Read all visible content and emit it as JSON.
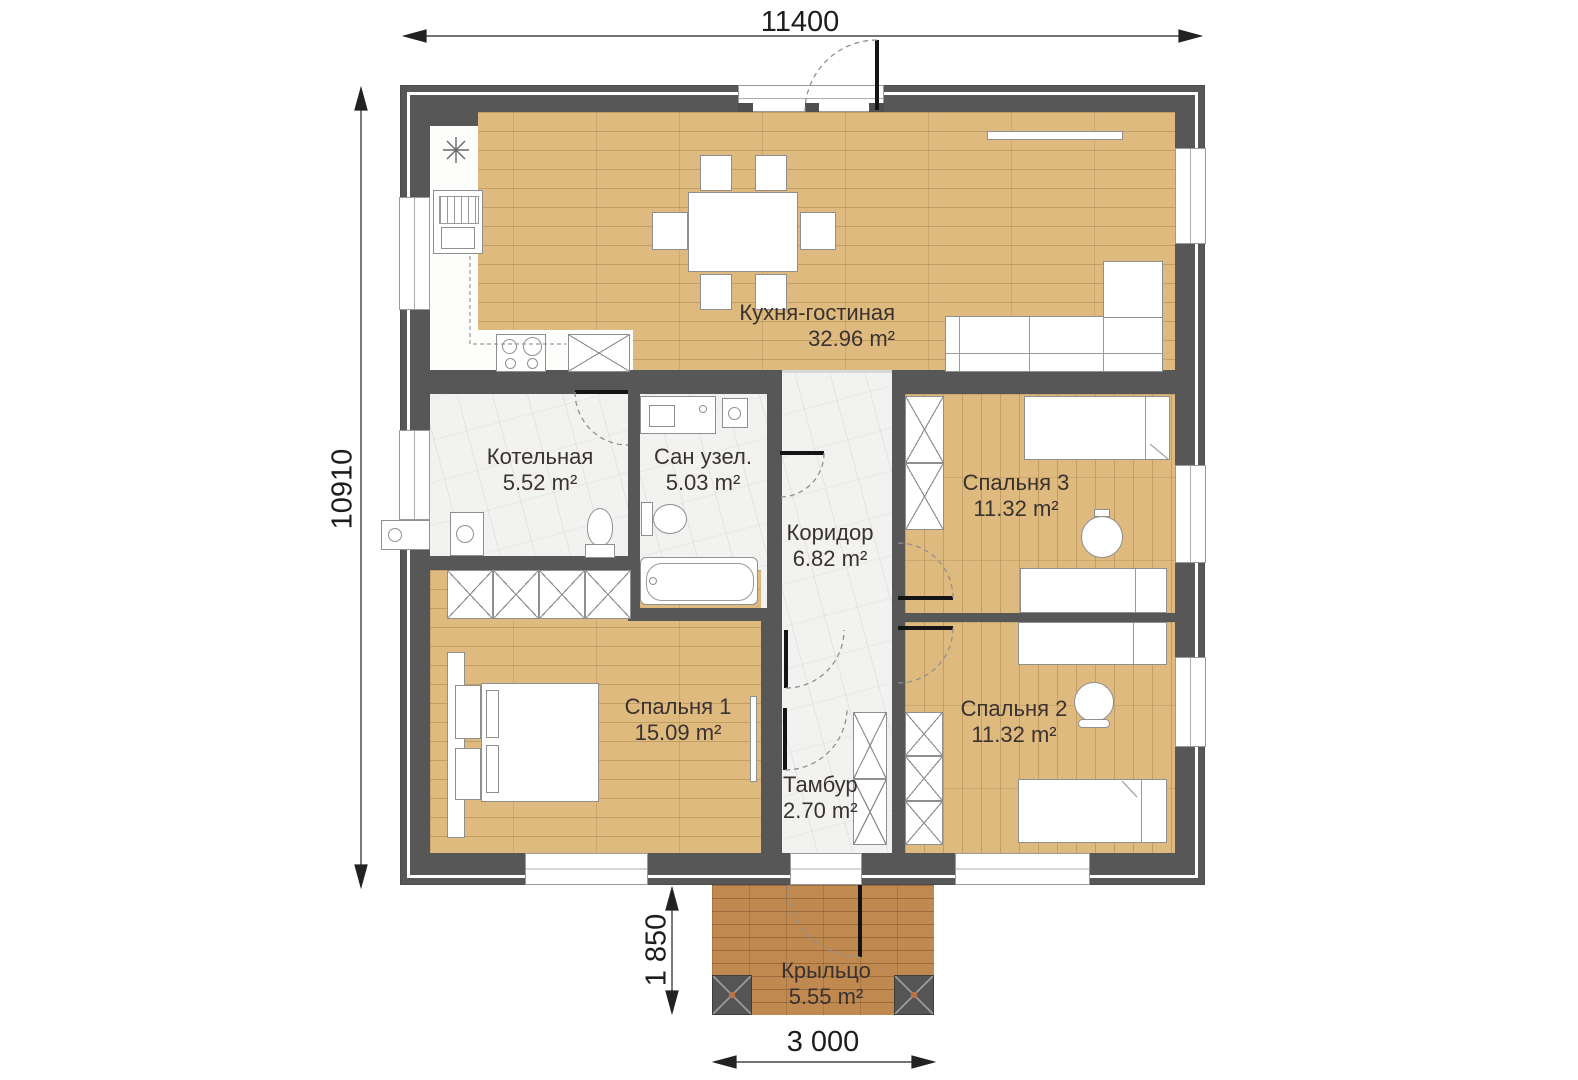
{
  "plan": {
    "dimensions": {
      "overall_width": "11400",
      "overall_height": "10910",
      "porch_depth": "1 850",
      "porch_width": "3 000"
    },
    "rooms": {
      "kitchen_living": {
        "name": "Кухня-гостиная",
        "area": "32.96 m²"
      },
      "boiler": {
        "name": "Котельная",
        "area": "5.52 m²"
      },
      "bathroom": {
        "name": "Сан узел.",
        "area": "5.03 m²"
      },
      "corridor": {
        "name": "Коридор",
        "area": "6.82 m²"
      },
      "bedroom1": {
        "name": "Спальня 1",
        "area": "15.09 m²"
      },
      "bedroom2": {
        "name": "Спальня 2",
        "area": "11.32 m²"
      },
      "bedroom3": {
        "name": "Спальня 3",
        "area": "11.32 m²"
      },
      "vestibule": {
        "name": "Тамбур",
        "area": "2.70 m²"
      },
      "porch": {
        "name": "Крыльцо",
        "area": "5.55 m²"
      }
    },
    "colors": {
      "wall": "#575757",
      "wood_floor": "#deba7e",
      "porch_floor": "#bf8950",
      "tile_floor": "#f2f2f0",
      "label_text": "#3a3230"
    },
    "icons": {
      "freezer": "asterisk-snowflake-icon"
    }
  }
}
